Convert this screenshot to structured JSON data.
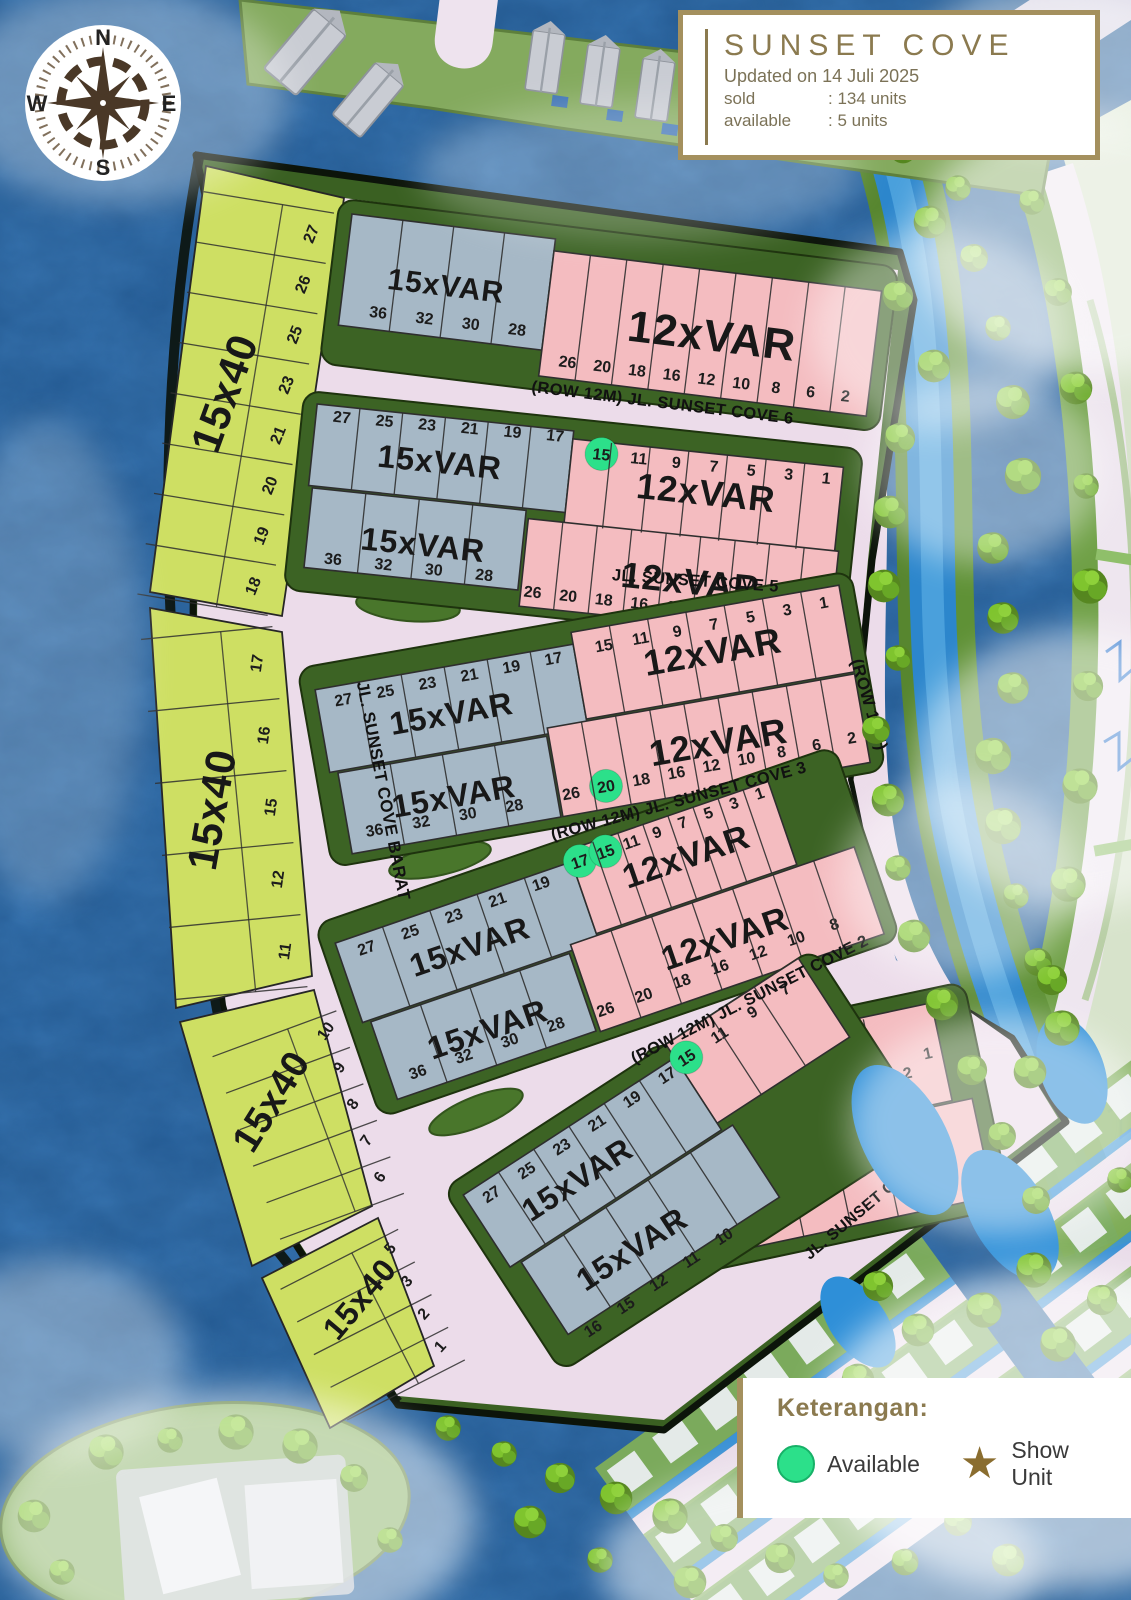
{
  "title_box": {
    "title": "SUNSET COVE",
    "updated": "Updated on 14 Juli 2025",
    "sold_label": "sold",
    "sold_value": ":  134 units",
    "available_label": "available",
    "available_value": ":  5 units"
  },
  "compass": {
    "north": "N",
    "east": "E",
    "south": "S",
    "west": "W"
  },
  "legend": {
    "heading": "Keterangan:",
    "available_label": "Available",
    "show_unit_label": "Show Unit",
    "available_icon": "green-circle",
    "show_unit_icon": "gold-star"
  },
  "labels": {
    "lot_blue": "15xVAR",
    "lot_pink": "12xVAR",
    "lot_green": "15x40"
  },
  "streets": {
    "barat": "JL. SUNSET COVE BARAT",
    "cove6": "(ROW 12M) JL. SUNSET COVE 6",
    "cove5": "JL. SUNSET COVE 5",
    "cove3": "(ROW 12M) JL. SUNSET COVE 3",
    "cove2": "(ROW 12M) JL. SUNSET COVE 2",
    "cove1": "JL. SUNSET COVE 1",
    "row18": "(ROW 18M)"
  },
  "west_strip": {
    "segment1": [
      "27",
      "26",
      "25",
      "23",
      "21",
      "20",
      "19",
      "18"
    ],
    "segment2": [
      "17",
      "16",
      "15",
      "12",
      "11"
    ],
    "segment3": [
      "10",
      "9",
      "8",
      "7",
      "6"
    ],
    "segment4": [
      "5",
      "3",
      "2",
      "1"
    ]
  },
  "blocks": {
    "a": {
      "bottom_blue": [
        "36",
        "32",
        "30",
        "28"
      ],
      "bottom_pink": [
        "26",
        "20",
        "18",
        "16",
        "12",
        "10",
        "8",
        "6",
        "2"
      ]
    },
    "b": {
      "top_blue": [
        "27",
        "25",
        "23",
        "21",
        "19",
        "17"
      ],
      "top_pink": [
        "15",
        "11",
        "9",
        "7",
        "5",
        "3",
        "1"
      ],
      "bottom_blue": [
        "36",
        "32",
        "30",
        "28"
      ],
      "bottom_pink": [
        "26",
        "20",
        "18",
        "16",
        "12",
        "10",
        "8",
        "6",
        "2"
      ]
    },
    "c": {
      "top_blue": [
        "27",
        "25",
        "23",
        "21",
        "19",
        "17"
      ],
      "top_pink": [
        "15",
        "11",
        "9",
        "7",
        "5",
        "3",
        "1"
      ],
      "bottom_blue": [
        "36",
        "32",
        "30",
        "28"
      ],
      "bottom_pink": [
        "26",
        "20",
        "18",
        "16",
        "12",
        "10",
        "8",
        "6",
        "2"
      ]
    },
    "d": {
      "top_blue": [
        "27",
        "25",
        "23",
        "21",
        "19"
      ],
      "top_pink": [
        "17",
        "15",
        "11",
        "9",
        "7",
        "5",
        "3",
        "1"
      ],
      "bottom_blue": [
        "36",
        "32",
        "30",
        "28"
      ],
      "bottom_pink": [
        "26",
        "20",
        "18",
        "16",
        "12",
        "10",
        "8"
      ]
    },
    "e": {
      "top_blue": [
        "27",
        "25",
        "23",
        "21",
        "19",
        "17"
      ],
      "top_pink": [
        "15",
        "11",
        "9",
        "7"
      ],
      "end_pink": [
        "9",
        "8",
        "7",
        "6",
        "5",
        "3",
        "2",
        "1"
      ],
      "bottom_blue": [
        "16",
        "15",
        "12",
        "11",
        "10"
      ]
    }
  },
  "available_lot_numbers": [
    "15",
    "20",
    "17",
    "15",
    "15"
  ],
  "colors": {
    "gold": "#8b7a4f",
    "gold_border": "#a4905e",
    "available_green": "#2ce08a",
    "lot_blue": "#a6b8c6",
    "lot_pink": "#f4bcc0",
    "lot_green": "#cedf63",
    "road": "#ecdcea",
    "water": "#1c5694",
    "belt_green": "#3c6324",
    "text_dark": "#2a2a2a"
  }
}
